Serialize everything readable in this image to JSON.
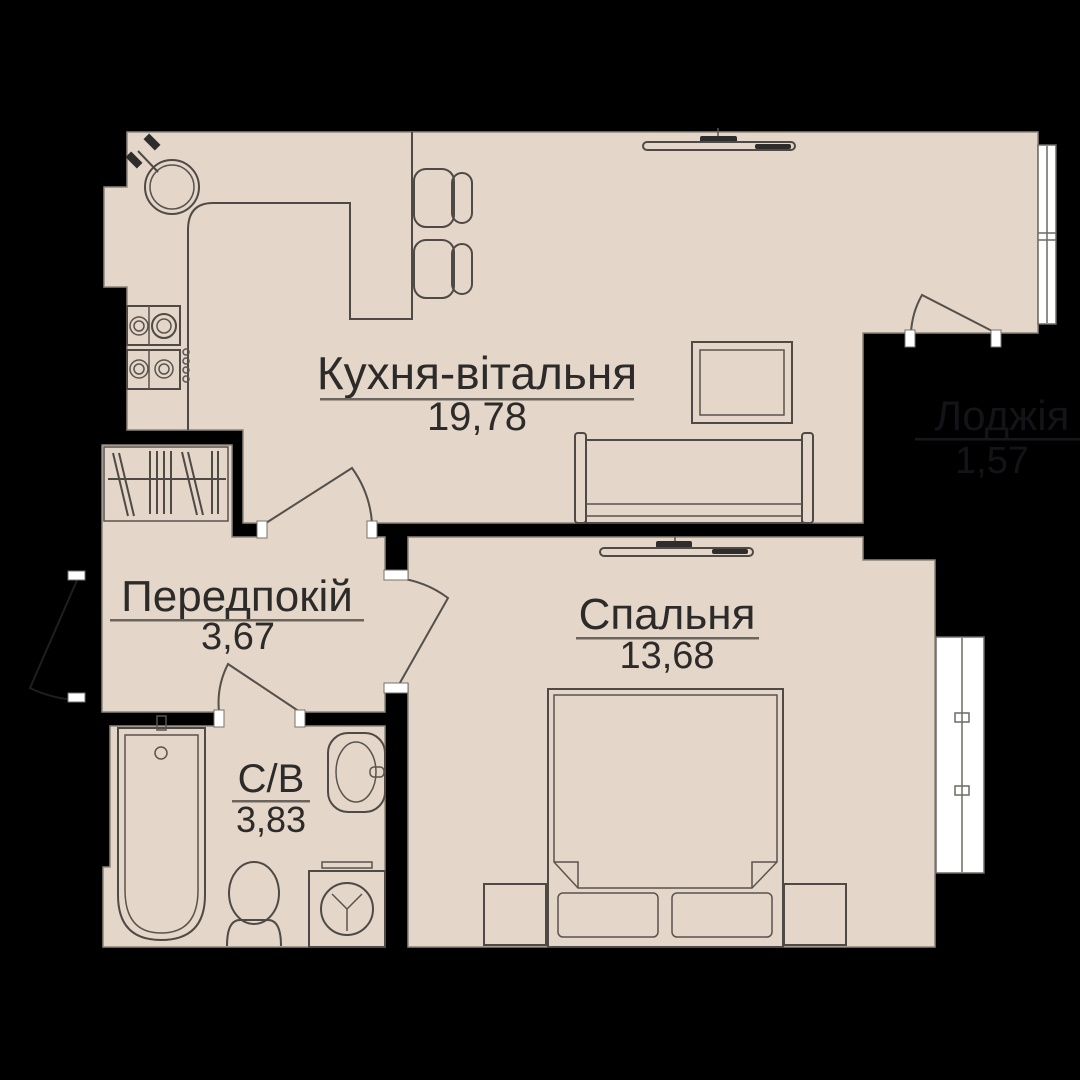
{
  "plan": {
    "title": "Apartment floor plan",
    "rooms": [
      {
        "id": "kitchen-living",
        "label": "Кухня-вітальня",
        "area": "19,78"
      },
      {
        "id": "bedroom",
        "label": "Спальня",
        "area": "13,68"
      },
      {
        "id": "hallway",
        "label": "Передпокій",
        "area": "3,67"
      },
      {
        "id": "bathroom",
        "label": "С/В",
        "area": "3,83"
      },
      {
        "id": "loggia",
        "label": "Лоджія",
        "area": "1,57"
      }
    ],
    "colors": {
      "background": "#000000",
      "floor": "#e4d6c9",
      "wall_edge": "#8d857c",
      "furniture_line": "#4f4a45",
      "text": "#2d2b29",
      "underline": "#6b655e",
      "window_white": "#ffffff",
      "loggia_muted_text": "#131318"
    }
  }
}
